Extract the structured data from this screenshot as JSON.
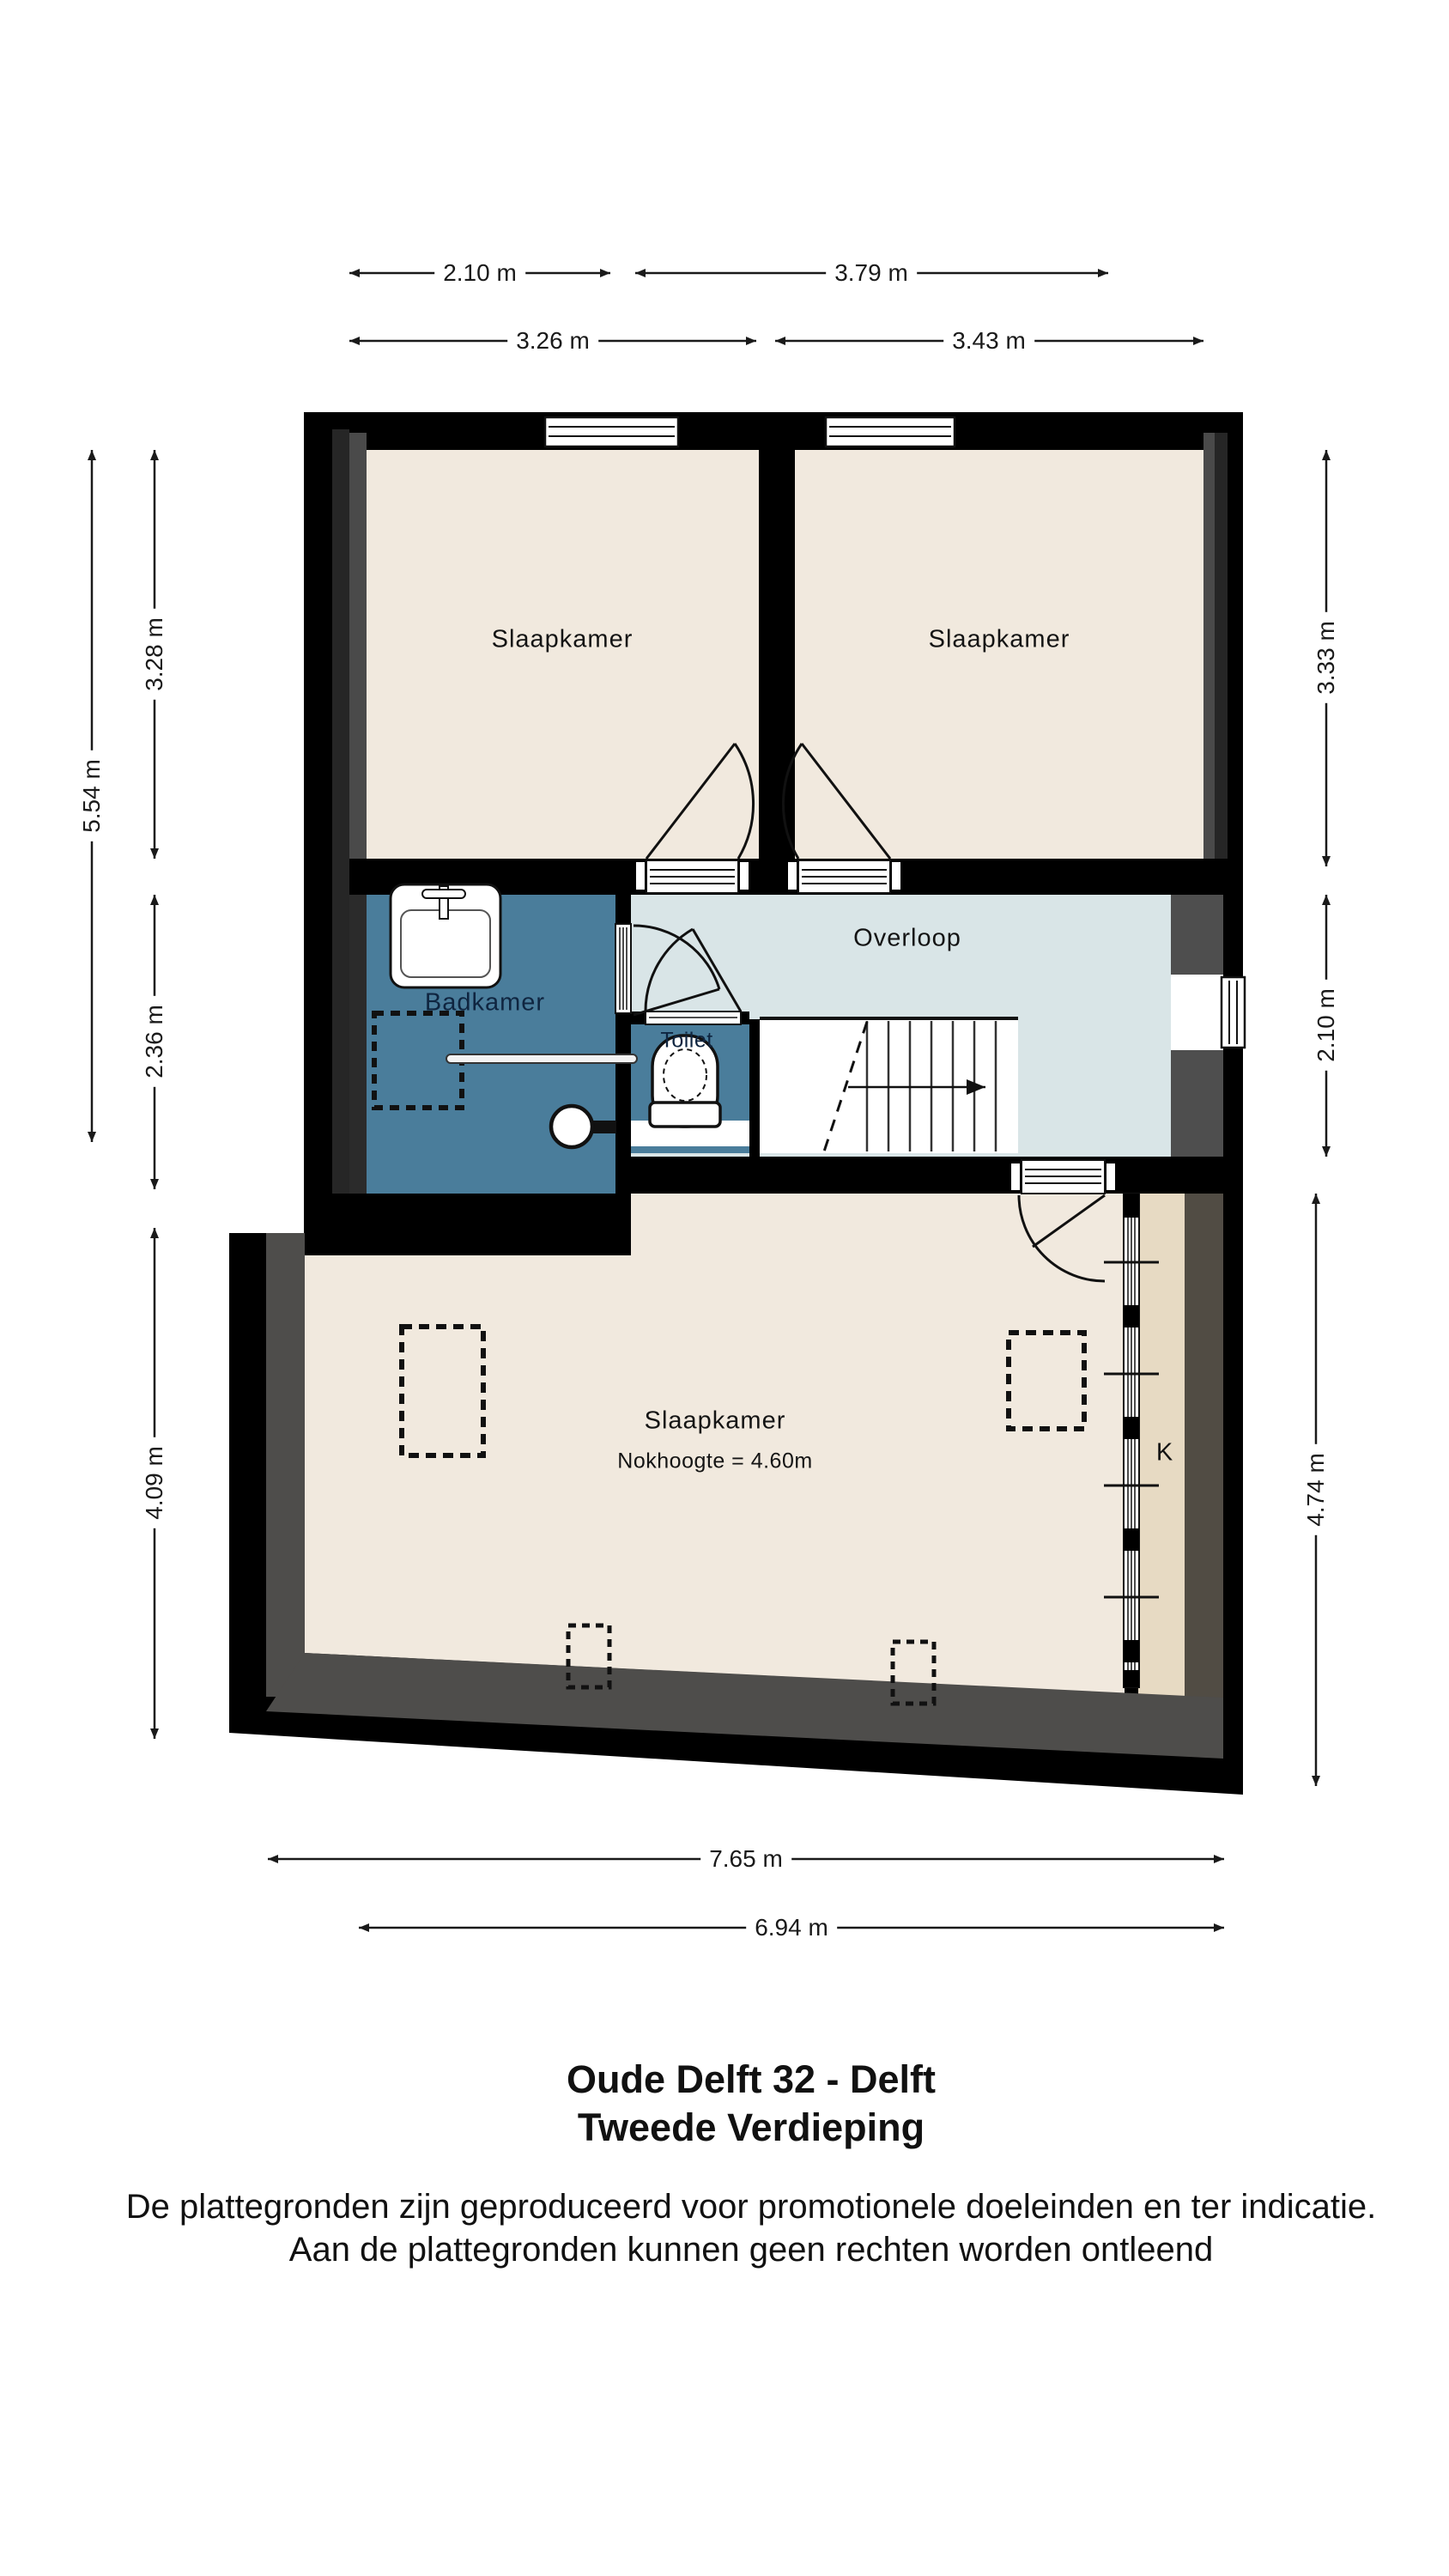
{
  "title": {
    "line1": "Oude Delft 32 - Delft",
    "line2": "Tweede Verdieping"
  },
  "disclaimer": {
    "line1": "De plattegronden zijn geproduceerd voor promotionele doeleinden en ter indicatie.",
    "line2": "Aan de plattegronden kunnen geen rechten worden ontleend"
  },
  "rooms": {
    "bedroom_top_left": "Slaapkamer",
    "bedroom_top_right": "Slaapkamer",
    "landing": "Overloop",
    "bathroom": "Badkamer",
    "toilet": "Toilet",
    "bedroom_large": "Slaapkamer",
    "bedroom_large_note": "Nokhoogte = 4.60m",
    "closet": "K"
  },
  "dims": {
    "top_left_inner": "2.10 m",
    "top_right_inner": "3.79 m",
    "top_left_outer": "3.26 m",
    "top_right_outer": "3.43 m",
    "left_total": "5.54 m",
    "left_upper": "3.28 m",
    "left_middle": "2.36 m",
    "left_lower": "4.09 m",
    "right_upper": "3.33 m",
    "right_middle": "2.10 m",
    "right_lower": "4.74 m",
    "bottom_outer": "7.65 m",
    "bottom_inner": "6.94 m"
  },
  "colors": {
    "wall": "#000000",
    "wall_shade_dark": "#262626",
    "wall_shade_light": "#4a4a4a",
    "floor_beige": "#f1e9de",
    "bathroom_blue": "#4a7d9b",
    "landing_blue": "#d9e5e7",
    "closet_tan": "#e7dac3",
    "slope_gray": "#4e4d4b",
    "side_band_brown": "#514c44",
    "stairs_white": "#ffffff"
  }
}
